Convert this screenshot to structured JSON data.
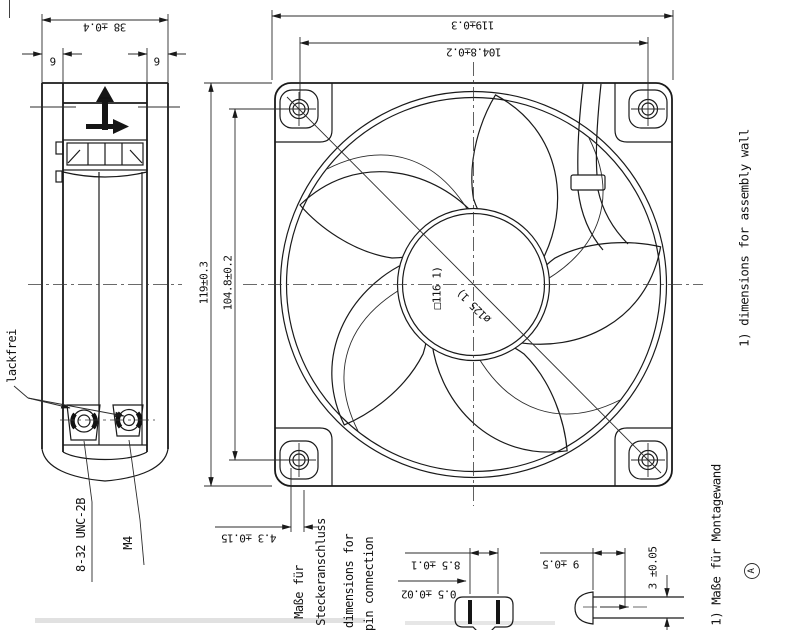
{
  "drawing": {
    "side_view": {
      "dim_width": "38 ±0.4",
      "dim_flange_left": "6",
      "dim_flange_right": "6",
      "label_lackfrei": "lackfrei",
      "label_thread_unc": "8-32 UNC-2B",
      "label_thread_m4": "M4"
    },
    "front_view": {
      "dim_top_width": "119±0.3",
      "dim_top_hole_spacing": "104.8±0.2",
      "dim_left_height": "119±0.3",
      "dim_left_hole_spacing": "104.8±0.2",
      "label_square_cutout": "□116 1)",
      "label_circle_cutout": "ø125 1)"
    },
    "connector": {
      "dim_offset": "4.3 ±0.15",
      "label_de_line1": "Maße für",
      "label_de_line2": "Steckeranschluss",
      "label_en_line1": "dimensions for",
      "label_en_line2": "pin connection",
      "dim_pin_spacing": "8.5 ±0.1",
      "dim_pin_thickness": "0.5 ±0.02",
      "dim_pin_length": "9 ±0.5",
      "dim_pin_width": "3 ±0.05"
    },
    "notes": {
      "note_en": "1) dimensions for assembly wall",
      "note_de": "1) Maße für Montagewand",
      "revision_mark": "A"
    }
  }
}
